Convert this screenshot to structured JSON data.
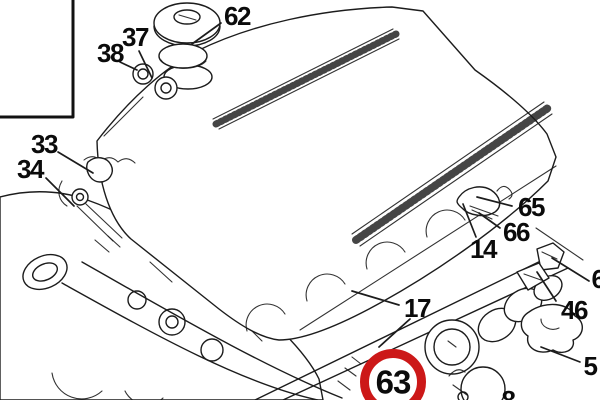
{
  "diagram": {
    "kind": "exploded-parts-line-drawing",
    "background": "#ffffff",
    "line_color": "#1c1c1c",
    "label_color": "#0b0b0b",
    "highlight": {
      "label": "63",
      "ring_color": "#cc1818",
      "cx": 393,
      "cy": 382,
      "outer_radius": 33,
      "ring_width": 9
    },
    "callouts": [
      {
        "label": "62",
        "x": 237,
        "y": 16,
        "leaders": [
          [
            221,
            23,
            192,
            44
          ]
        ]
      },
      {
        "label": "37",
        "x": 135,
        "y": 37,
        "leaders": [
          [
            139,
            51,
            152,
            78
          ]
        ]
      },
      {
        "label": "38",
        "x": 110,
        "y": 53,
        "leaders": [
          [
            120,
            62,
            137,
            70
          ]
        ]
      },
      {
        "label": "33",
        "x": 44,
        "y": 144,
        "leaders": [
          [
            58,
            152,
            93,
            173
          ]
        ]
      },
      {
        "label": "34",
        "x": 30,
        "y": 169,
        "leaders": [
          [
            46,
            178,
            74,
            206
          ]
        ]
      },
      {
        "label": "65",
        "x": 531,
        "y": 207,
        "leaders": [
          [
            512,
            206,
            477,
            197
          ]
        ]
      },
      {
        "label": "66",
        "x": 516,
        "y": 232,
        "leaders": [
          [
            500,
            228,
            479,
            213
          ]
        ]
      },
      {
        "label": "14",
        "x": 483,
        "y": 249,
        "leaders": [
          [
            476,
            237,
            463,
            204
          ]
        ]
      },
      {
        "label": "17",
        "x": 417,
        "y": 308,
        "leaders": [
          [
            399,
            305,
            352,
            291
          ],
          [
            410,
            319,
            379,
            347
          ]
        ]
      },
      {
        "label": "6",
        "x": 598,
        "y": 279,
        "leaders": [
          [
            589,
            281,
            552,
            258
          ]
        ]
      },
      {
        "label": "46",
        "x": 574,
        "y": 310,
        "leaders": [
          [
            556,
            301,
            537,
            272
          ]
        ]
      },
      {
        "label": "5",
        "x": 590,
        "y": 366,
        "leaders": [
          [
            580,
            362,
            541,
            347
          ]
        ]
      },
      {
        "label": "8",
        "x": 508,
        "y": 400,
        "leaders": []
      }
    ]
  }
}
